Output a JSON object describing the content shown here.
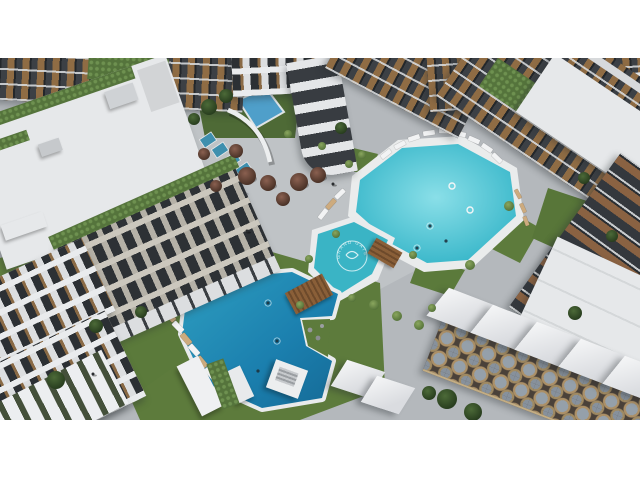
{
  "scene": {
    "logo": {
      "text": "GRAND GATE"
    },
    "palette": {
      "letterbox": "#ffffff",
      "pavement": "#b4b8bc",
      "lawn": "#5d7b3c",
      "pool_turquoise": "#2fb2c6",
      "pool_deep_blue": "#1b7fae",
      "roof_white": "#e6e8ea",
      "facade_dark": "#3c4045",
      "wood_accent": "#8a6a45",
      "mosaic_paving": "#4a4139"
    }
  }
}
